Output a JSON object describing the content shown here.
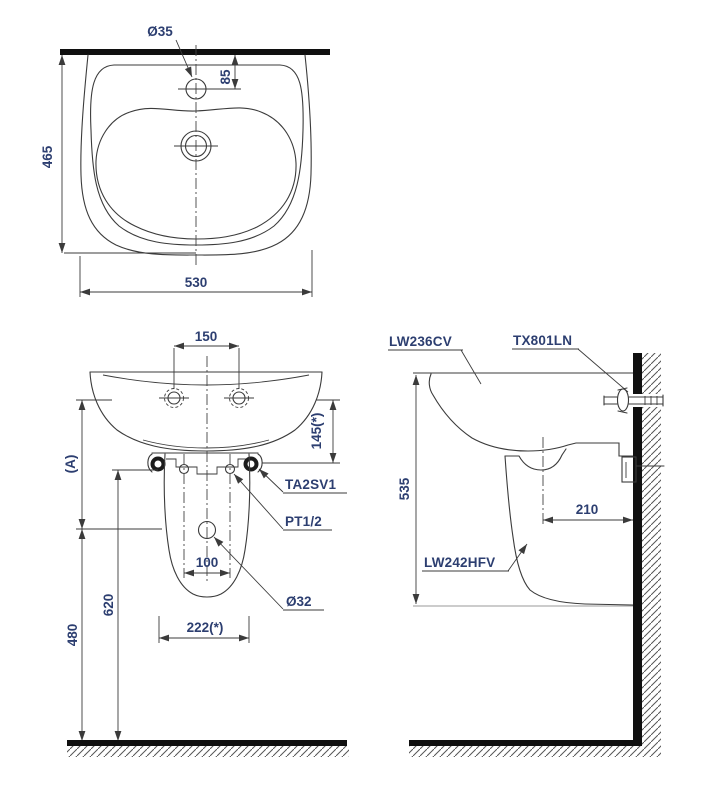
{
  "drawing_type": "basin installation dimension drawing",
  "colors": {
    "line": "#3b3b3b",
    "dimension_text": "#2c3e70",
    "solid_bar": "#101010",
    "hatch": "#555555",
    "background": "#ffffff"
  },
  "top_view": {
    "dims": {
      "hole_diameter": "Ø35",
      "hole_offset": "85",
      "depth": "465",
      "width": "530"
    }
  },
  "front_view": {
    "dims": {
      "faucet_spacing": "150",
      "rim_to_bolt": "145(*)",
      "ref_a": "(A)",
      "supply_height": "620",
      "drain_height": "480",
      "bolt_spacing": "100",
      "base_width": "222(*)",
      "drain_diameter": "Ø32"
    },
    "labels": {
      "bracket": "TA2SV1",
      "supply": "PT1/2"
    }
  },
  "side_view": {
    "dims": {
      "height": "535",
      "drain_offset": "210"
    },
    "labels": {
      "basin": "LW236CV",
      "faucet": "TX801LN",
      "pedestal": "LW242HFV"
    }
  }
}
